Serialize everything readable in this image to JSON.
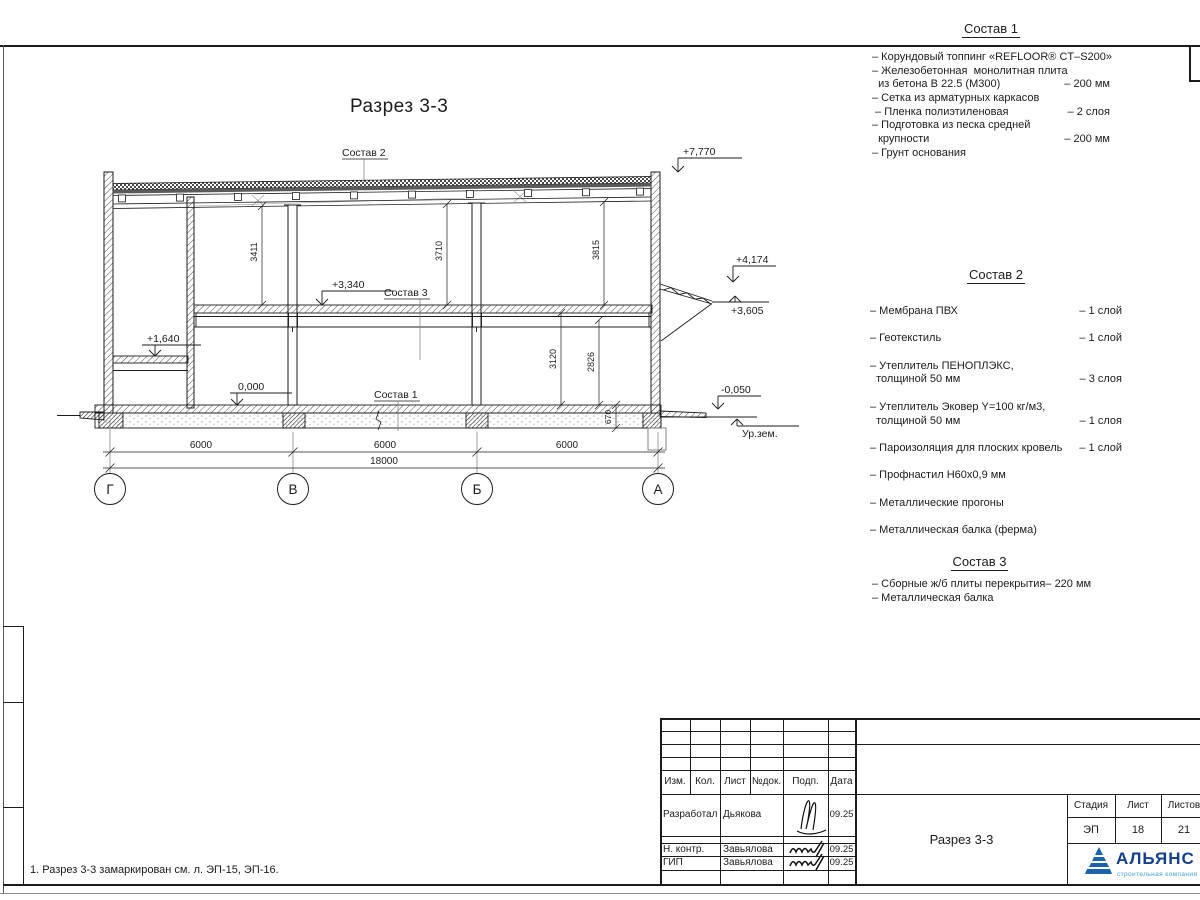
{
  "drawing": {
    "title": "Разрез 3-3",
    "label_sostav1": "Состав 1",
    "label_sostav2": "Состав 2",
    "label_sostav3": "Состав 3",
    "elev_roof": "+7,770",
    "elev_canopy_top": "+4,174",
    "elev_canopy_bottom": "+3,605",
    "elev_mezzanine": "+3,340",
    "elev_landing": "+1,640",
    "elev_zero": "0,000",
    "elev_ground": "-0,050",
    "ground_level_label": "Ур.зем.",
    "dim_3411": "3411",
    "dim_3710": "3710",
    "dim_3815": "3815",
    "dim_3120": "3120",
    "dim_2826": "2826",
    "dim_670": "670",
    "spans": [
      "6000",
      "6000",
      "6000"
    ],
    "span_total": "18000",
    "axes": [
      "Г",
      "В",
      "Б",
      "А"
    ]
  },
  "lists": [
    {
      "title": "Состав 1",
      "rows": [
        {
          "t": "– Корундовый топпинг «REFLOOR® CT–S200»",
          "q": ""
        },
        {
          "t": "– Железобетонная  монолитная плита",
          "q": ""
        },
        {
          "t": "  из бетона В 22.5 (М300)",
          "q": "– 200 мм"
        },
        {
          "t": "– Сетка из арматурных каркасов",
          "q": ""
        },
        {
          "t": " – Пленка полиэтиленовая",
          "q": "– 2 слоя"
        },
        {
          "t": "– Подготовка из песка средней",
          "q": ""
        },
        {
          "t": "  крупности",
          "q": "– 200 мм"
        },
        {
          "t": "– Грунт основания",
          "q": ""
        }
      ]
    },
    {
      "title": "Состав 2",
      "rows": [
        {
          "t": "– Мембрана ПВХ",
          "q": "– 1 слой"
        },
        {
          "t": "",
          "q": ""
        },
        {
          "t": "– Геотекстиль",
          "q": "– 1 слой"
        },
        {
          "t": "",
          "q": ""
        },
        {
          "t": "– Утеплитель ПЕНОПЛЭКС,",
          "q": ""
        },
        {
          "t": "  толщиной 50 мм",
          "q": "– 3 слоя"
        },
        {
          "t": "",
          "q": ""
        },
        {
          "t": "– Утеплитель Эковер Y=100 кг/м3,",
          "q": ""
        },
        {
          "t": "  толщиной 50 мм",
          "q": "– 1 слоя"
        },
        {
          "t": "",
          "q": ""
        },
        {
          "t": "– Пароизоляция для плоских кровель",
          "q": "– 1 слой"
        },
        {
          "t": "",
          "q": ""
        },
        {
          "t": "– Профнастил Н60х0,9 мм",
          "q": ""
        },
        {
          "t": "",
          "q": ""
        },
        {
          "t": "– Металлические прогоны",
          "q": ""
        },
        {
          "t": "",
          "q": ""
        },
        {
          "t": "– Металлическая балка (ферма)",
          "q": ""
        }
      ]
    },
    {
      "title": "Состав 3",
      "rows": [
        {
          "t": "– Сборные ж/б плиты перекрытия",
          "q": "– 220 мм"
        },
        {
          "t": "– Металлическая балка",
          "q": ""
        }
      ]
    }
  ],
  "note": "1. Разрез 3-3 замаркирован см. л. ЭП-15, ЭП-16.",
  "titleblock": {
    "rev_headers": [
      "Изм.",
      "Кол.",
      "Лист",
      "№док.",
      "Подп.",
      "Дата"
    ],
    "staff": [
      {
        "role": "Разработал",
        "name": "Дьякова",
        "date": "09.25"
      },
      {
        "role": "Н. контр.",
        "name": "Завьялова",
        "date": "09.25"
      },
      {
        "role": "ГИП",
        "name": "Завьялова",
        "date": "09.25"
      }
    ],
    "sheet_title": "Разрез 3-3",
    "stage_header": "Стадия",
    "sheet_header": "Лист",
    "sheets_header": "Листов",
    "stage": "ЭП",
    "sheet_number": "18",
    "sheets_total": "21",
    "company_name": "АЛЬЯНС",
    "company_tagline": "строительная компания",
    "colors": {
      "logo_blue": "#1c63ae",
      "logo_text_blue": "#14418f",
      "logo_tagline_blue": "#3d9fd9"
    }
  }
}
